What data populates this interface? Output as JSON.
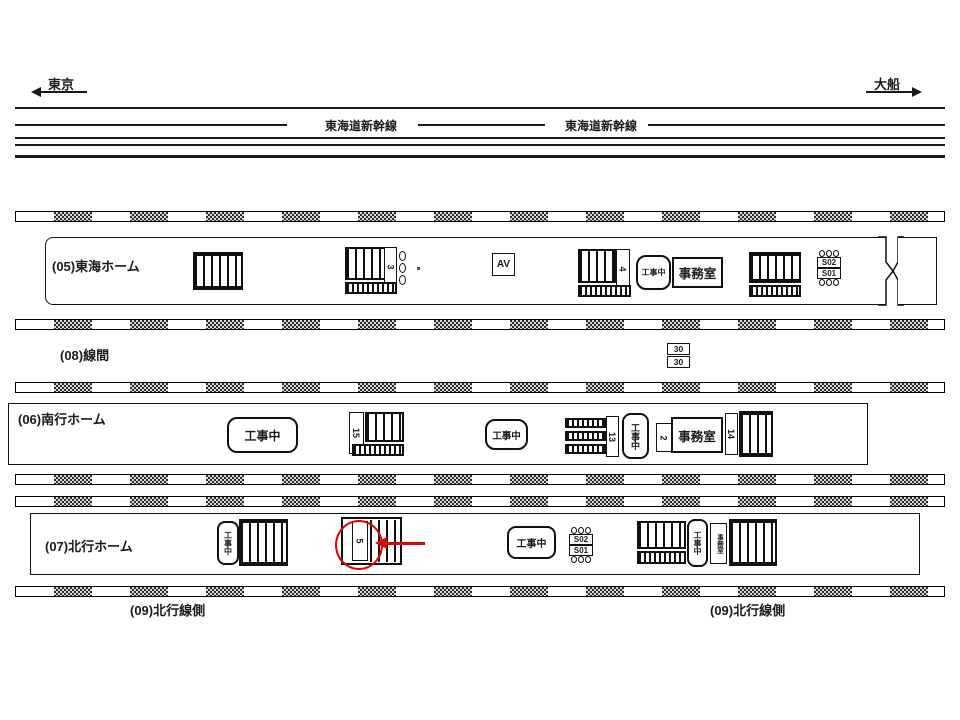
{
  "diagram": {
    "terminals": {
      "left": "東京",
      "right": "大船"
    },
    "line_name": "東海道新幹線",
    "platform_labels": {
      "p05": "(05)東海ホーム",
      "p08": "(08)線間",
      "p06": "(06)南行ホーム",
      "p07": "(07)北行ホーム",
      "p09_left": "(09)北行線側",
      "p09_right": "(09)北行線側"
    },
    "boxes": {
      "construction": "工事中",
      "office": "事務室",
      "av": "AV",
      "signal_top": "S02",
      "signal_bottom": "S01",
      "interval_top": "30",
      "interval_bottom": "30"
    },
    "stair_numbers": {
      "p05_center": "3",
      "p05_right": "4",
      "p06_left": "15",
      "p06_center": "13",
      "p06_small": "2",
      "p06_right": "14",
      "p07_circled": "5"
    },
    "colors": {
      "ink": "#1a1a1a",
      "highlight": "#e60000"
    }
  }
}
